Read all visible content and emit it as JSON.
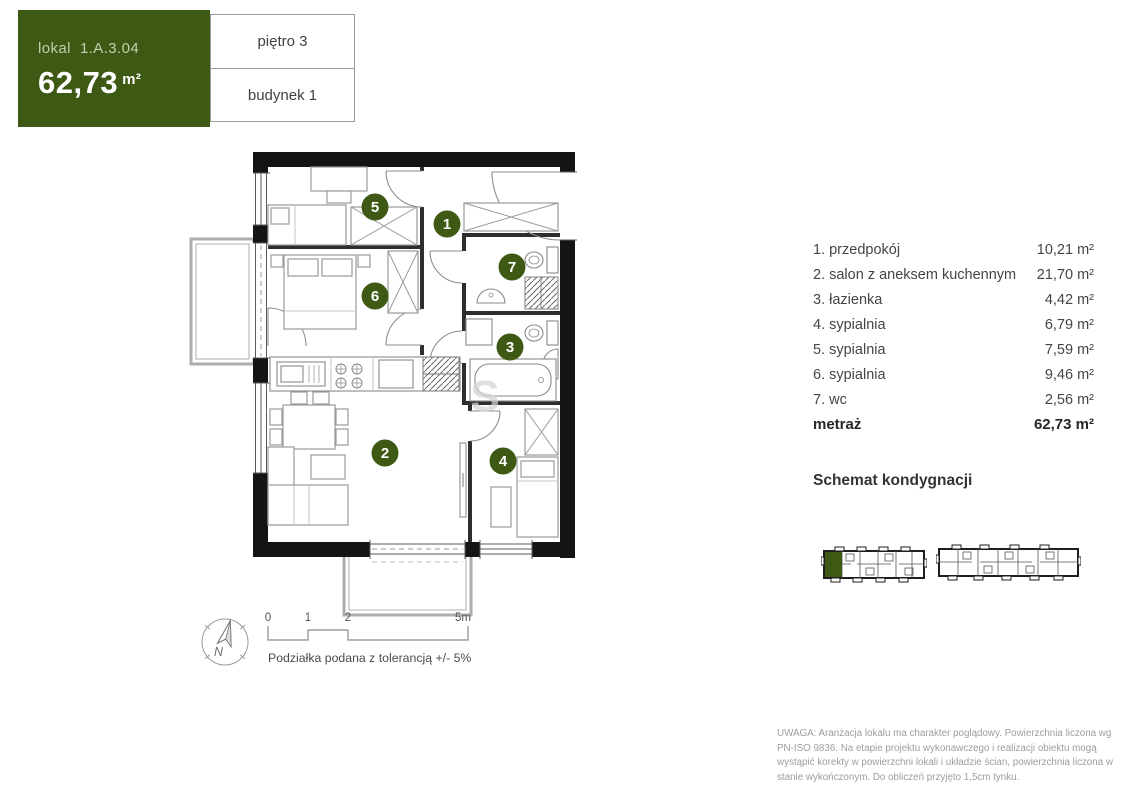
{
  "header": {
    "unit_label": "lokal",
    "unit_id": "1.A.3.04",
    "area_value": "62,73",
    "area_unit": "m²",
    "floor": "piętro 3",
    "building": "budynek 1"
  },
  "legend": {
    "rooms": [
      {
        "name": "1. przedpokój",
        "area": "10,21 m²"
      },
      {
        "name": "2. salon z aneksem kuchennym",
        "area": "21,70 m²"
      },
      {
        "name": "3. łazienka",
        "area": "4,42 m²"
      },
      {
        "name": "4. sypialnia",
        "area": "6,79 m²"
      },
      {
        "name": "5. sypialnia",
        "area": "7,59 m²"
      },
      {
        "name": "6. sypialnia",
        "area": "9,46 m²"
      },
      {
        "name": "7. wc",
        "area": "2,56 m²"
      }
    ],
    "total_label": "metraż",
    "total_area": "62,73 m²"
  },
  "plan": {
    "circle_numbers": {
      "hall": "1",
      "living": "2",
      "bath": "3",
      "bedroom4": "4",
      "bedroom5": "5",
      "bedroom6": "6",
      "wc": "7"
    },
    "watermark": "S"
  },
  "schemat": {
    "title": "Schemat kondygnacji"
  },
  "scalebar": {
    "ticks": [
      "0",
      "1",
      "2",
      "5m"
    ],
    "note": "Podziałka podana z tolerancją +/- 5%"
  },
  "compass": {
    "label": "N"
  },
  "disclaimer": "UWAGA: Aranżacja lokalu ma charakter poglądowy. Powierzchnia liczona wg PN-ISO 9836. Na etapie projektu wykonawczego i realizacji obiektu mogą wystąpić korekty w powierzchni lokali i układzie ścian, powierzchnia liczona w stanie wykończonym. Do obliczeń przyjęto 1,5cm tynku.",
  "colors": {
    "accent_green": "#3e5913",
    "wall_black": "#141414"
  }
}
